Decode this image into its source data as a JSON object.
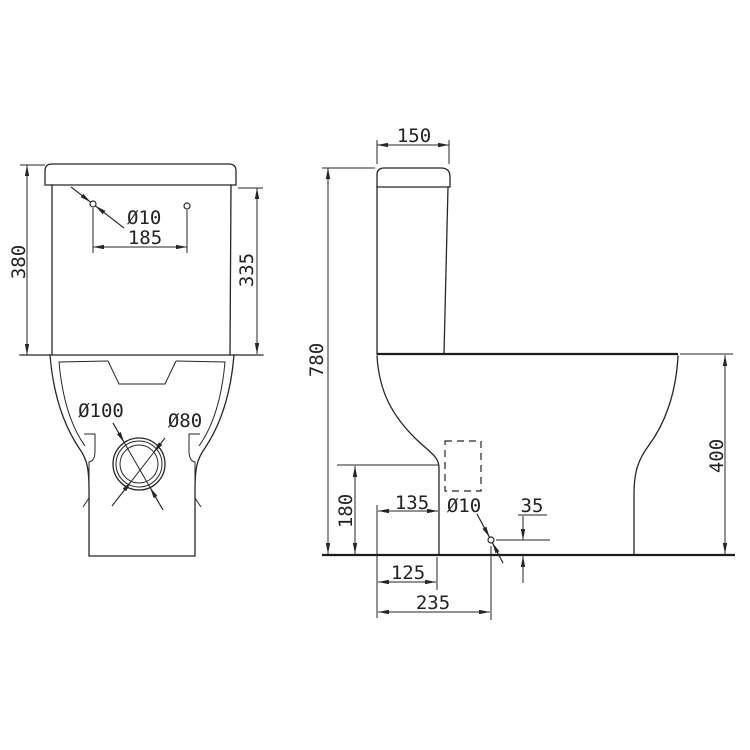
{
  "drawing": {
    "background": "#ffffff",
    "line_color": "#262626",
    "front_view": {
      "dims": {
        "overall_height": "380",
        "tank_height": "335",
        "lid_hole_diameter": "Ø10",
        "lid_hole_spacing": "185",
        "outlet_outer_diameter": "Ø100",
        "outlet_inner_diameter": "Ø80"
      }
    },
    "side_view": {
      "dims": {
        "lid_depth": "150",
        "overall_height": "780",
        "pan_height": "400",
        "outlet_center_height": "180",
        "outlet_setback": "135",
        "fixing_hole_diameter": "Ø10",
        "fixing_hole_height": "35",
        "foot_depth": "125",
        "fixing_hole_setback": "235"
      }
    }
  }
}
